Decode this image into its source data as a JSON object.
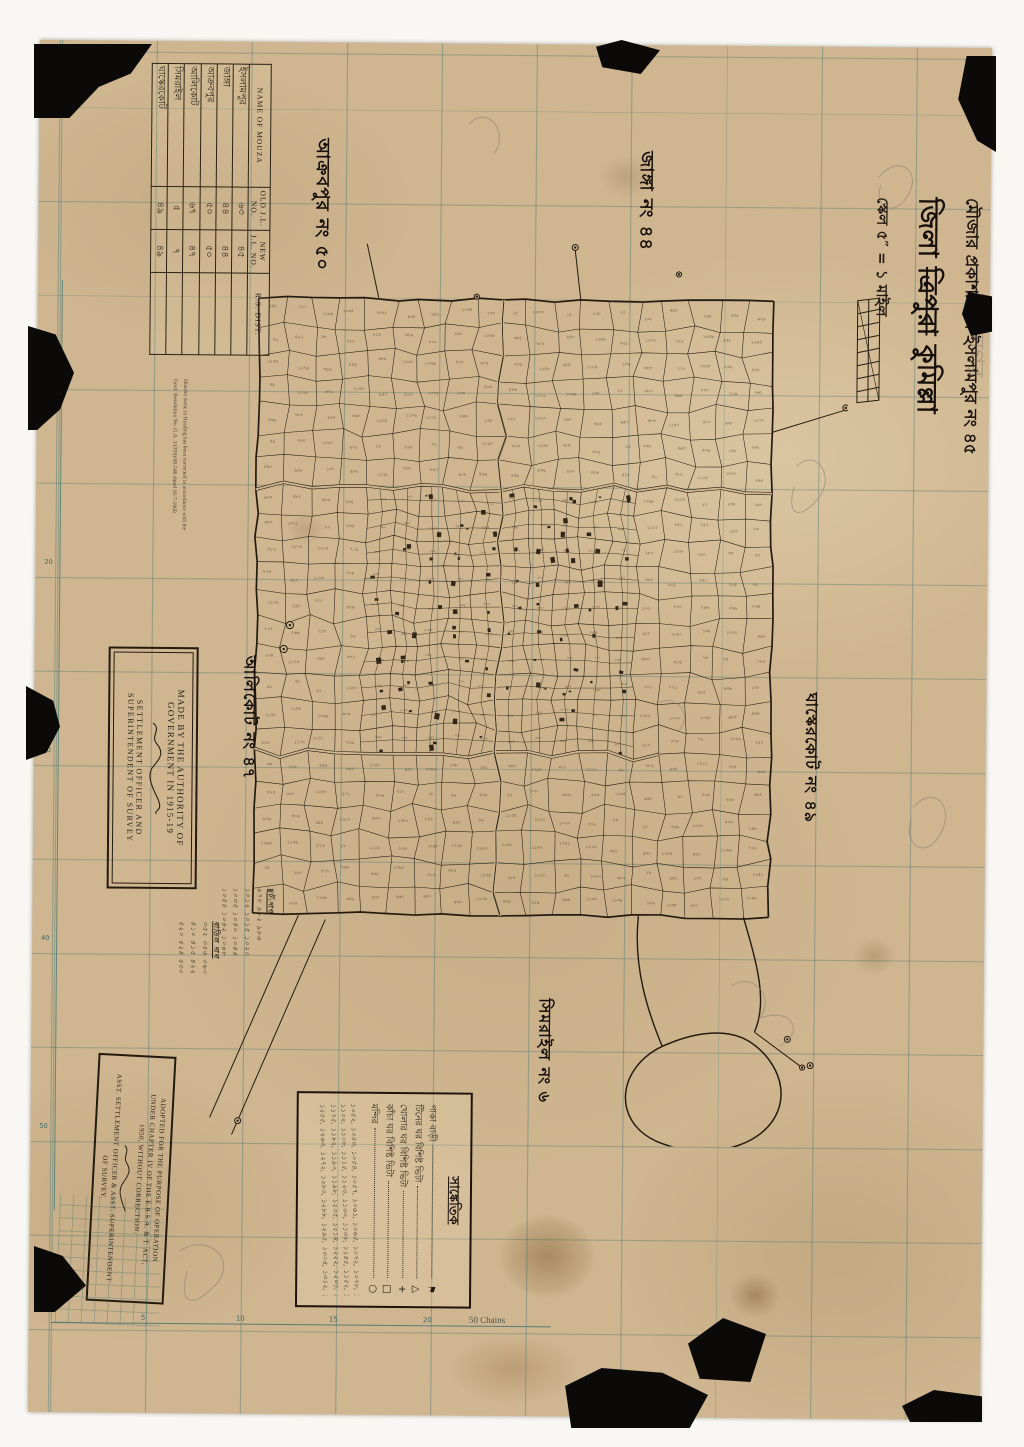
{
  "colors": {
    "paper": "#cfb690",
    "ink": "#241b10",
    "grid": "#3f7d7c",
    "pencil": "#8a8275",
    "stamp": "#2a2118"
  },
  "mouza_table": {
    "headers": {
      "name": "NAME OF MOUZA",
      "old": "OLD J.L. NO.",
      "new": "NEW J.L. NO.",
      "rs": "R.S.  DIST."
    },
    "rows": [
      {
        "name": "ইসলামপুর",
        "old": "৬৩",
        "new": "৪৫",
        "rs": ""
      },
      {
        "name": "জাঙ্গা",
        "old": "৪৪",
        "new": "৪৪",
        "rs": ""
      },
      {
        "name": "আক্রবপুর",
        "old": "৫০",
        "new": "৫০",
        "rs": ""
      },
      {
        "name": "আলিকোট",
        "old": "৬৭",
        "new": "৪৭",
        "rs": ""
      },
      {
        "name": "সিমরাইল",
        "old": "৫",
        "new": "৭",
        "rs": ""
      },
      {
        "name": "ঘাস্কেরকোট",
        "old": "৪৯",
        "new": "৪৯",
        "rs": ""
      }
    ]
  },
  "title_block": {
    "line1": "মৌজার প্রকাশ্য নাম ইসলামপুর নং ৪৫",
    "faint_line": "বাদ নগর",
    "district_prefix": "জিলা",
    "district_old": "ত্রিপুরা",
    "district_new": "কুমিল্লা",
    "scale_line": "স্কেল ৫″ = ১ মাইল"
  },
  "neighbor_labels": {
    "north_west": "আক্রবপুর নং ৫০",
    "north": "জাঙ্গা নং ৪৪",
    "west": "আলিকোট নং ৪৭",
    "east": "ঘাস্কেরকোট নং ৪৯",
    "south": "সিমরাইল নং ৬"
  },
  "made_by_box": {
    "line1": "MADE BY THE AUTHORITY OF GOVERNMENT IN 1915-19",
    "line2": "SETTLEMENT OFFICER AND SUPERINTENDENT OF SURVEY"
  },
  "adopted_box": {
    "lines": [
      "ADOPTED FOR THE PURPOSE OF OPERATION",
      "UNDER CHAPTER IV OF THE E.B.S.A. & T. ACT,",
      "1950, WITHOUT CORRECTION.",
      "ASST. SETTLEMENT OFFICER & ASST. SUPERINTENDENT",
      "OF SURVEY."
    ]
  },
  "correction_note": {
    "line1": "District name in Heading has been corrected in accordance with the",
    "line2": "Govt. Resolution No. G.A. 1/(359)/60-546 dated 16-7-1960."
  },
  "legend": {
    "title": "সাঙ্কেতিক",
    "items": [
      {
        "label": "পাকা বাড়ী",
        "symbol": "⚑"
      },
      {
        "label": "টিনের ঘর বিশিষ্ট ভিটা",
        "symbol": "△"
      },
      {
        "label": "খোলার ঘর বিশিষ্ট ভিটা",
        "symbol": "+"
      },
      {
        "label": "কাঁচা ঘর বিশিষ্ট ভিটা",
        "symbol": "□"
      },
      {
        "label": "মন্দির",
        "symbol": "○"
      }
    ],
    "plot_lists": [
      "১০৫২, ১০৫৩, ১০৫৪, ১০৫৭, ১০৬১, ১০৬৫, ১০৭২, ১০৭৮, ১০৮৪, ১০৯০,",
      "১১০২, ১১০৮, ১১১৫, ১১২৩, ১১৩০, ১১৩৮, ১১৪৫, ১১৫২, ১১৬০, ১১৬৮,",
      "১১৭৫, ১১৮২, ১১৯০, ১১৯৮, ১২০৫, ১২১৪, ১২২২, ১২৩১, ১২৪০, ১২৪৮,",
      "১২৫৫, ১২৬৩, ১২৭২, ১২৮০, ১২৮৮, ১২৯৫, ১৩০৪, ১৩১২, ১৩১৮, ১৩২৫"
    ]
  },
  "hand_lists": [
    {
      "title": "ছুট দাগ",
      "lines": "৯৭৮ ৯৮২ ৯৮৬\n১০১২ ১০১৫ ১০২০\n১০৩৫ ১০৪০ ১০৪৪\n১০৫৫ ১০৬২ ১০৬৮"
    },
    {
      "title": "বাতিল দাগ",
      "lines": "৩৫২ ৩৫৬ ৩৬০\n৪১০ ৪১৫ ৪২২\n৫২০ ৫২৪ ৫৩০"
    }
  ],
  "margin": {
    "chains_label": "50 Chains",
    "bottom_numbers": [
      "5",
      "10",
      "15",
      "20"
    ],
    "left_numbers": [
      "10",
      "20",
      "30",
      "40",
      "50"
    ]
  }
}
